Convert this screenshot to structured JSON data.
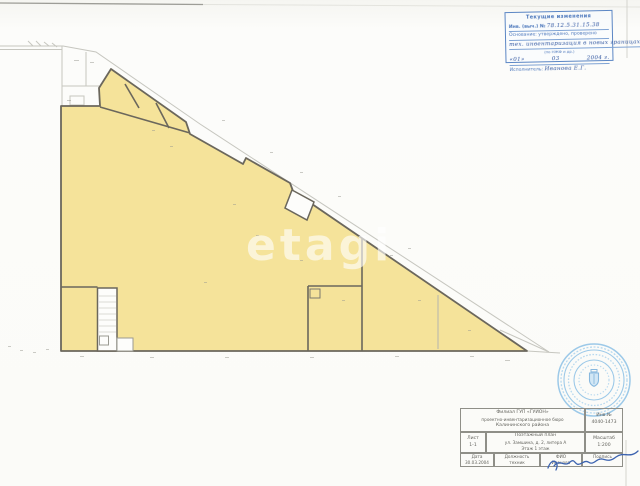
{
  "colors": {
    "highlight_yellow": "#f5e39a",
    "wall_dark": "#6b675c",
    "faint_line": "#c6c6bf",
    "stamp_blue": "#4f7fc0",
    "handwriting_blue": "#2f55a0",
    "seal_blue": "#8fc0e4"
  },
  "watermark": {
    "text": "etagi"
  },
  "correction_stamp": {
    "title": "Текущие изменения",
    "line1_label": "Инв. (выч.) №",
    "line1_value": "78.12.5.31.15.38",
    "line2": "Основание: утверждено, проверено",
    "line3": "тех. инвентаризация в новых границах",
    "line4_note": "(по НЖФ и др.)",
    "line4_left": "«01»",
    "line4_mid": "03",
    "line4_right": "2004 г.",
    "line5_label": "Исполнитель:",
    "line5_value": "Иванова Е.Г."
  },
  "title_block": {
    "org_line1": "Филиал ГУП «ГУИОН»",
    "org_line2": "проектно-инвентаризационное бюро",
    "org_line3": "Калининского района",
    "inv_label": "Инв.№",
    "inv_value": "4040-1473",
    "sheet_label": "Лист",
    "sheet_value": "1-1",
    "doc_line1": "Поэтажный план",
    "doc_line2": "ул. Замшина, д. 2, литера А",
    "doc_line3": "Этаж 1 этаж",
    "scale_label": "Масштаб",
    "scale_value": "1:200",
    "col_date": "Дата",
    "col_position": "Должность",
    "col_name": "ФИО",
    "col_sign": "Подпись",
    "val_date": "30.03.2004",
    "val_position": "техник",
    "val_name": "Иванова"
  }
}
